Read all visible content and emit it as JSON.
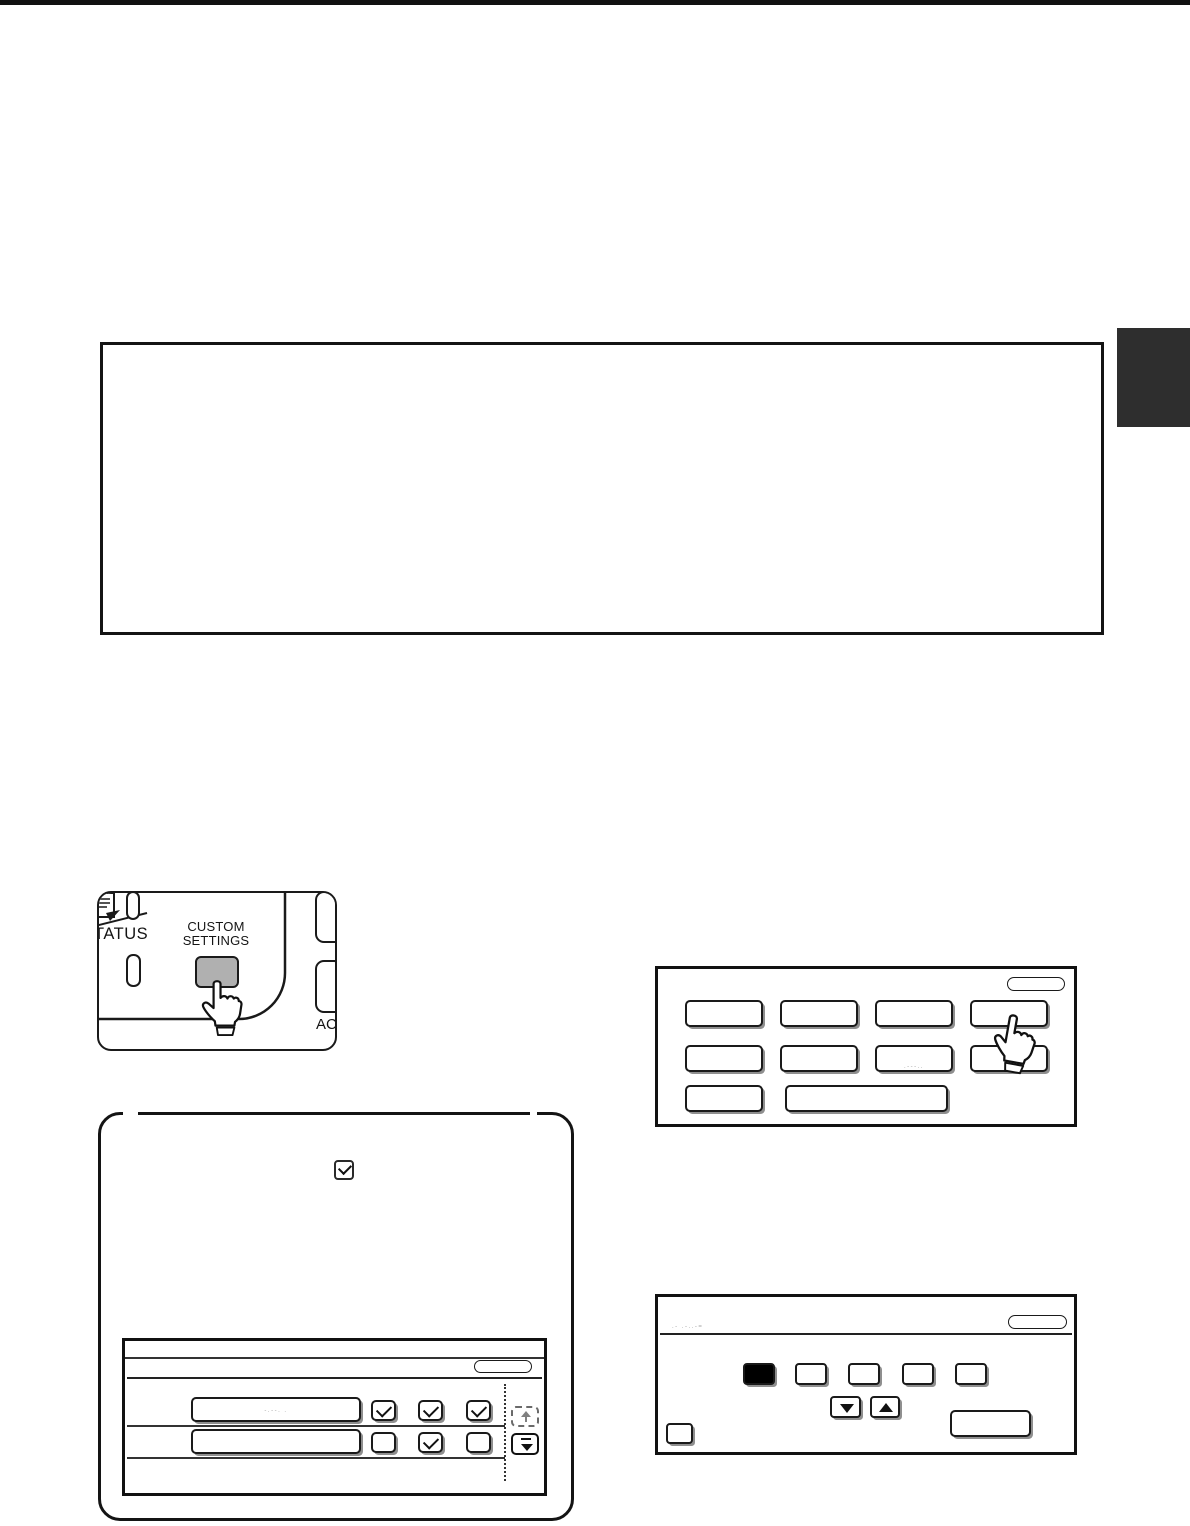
{
  "page": {
    "background": "#ffffff",
    "top_edge_color": "#111111",
    "side_tab_color": "#2e2e2e"
  },
  "note_frame": {
    "border_color": "#141414"
  },
  "panel": {
    "status_label_partial": "TATUS",
    "key_label_line1": "CUSTOM",
    "key_label_line2": "SETTINGS",
    "ac_label_partial": "AC",
    "key_color": "#b0b0b0"
  },
  "note_box": {
    "checkbox_state": "checked",
    "screen": {
      "row1": {
        "illegible_text": "-.--. .",
        "checkboxes": [
          "checked",
          "checked",
          "checked"
        ]
      },
      "row2": {
        "illegible_text": "",
        "checkboxes": [
          "unchecked",
          "checked",
          "unchecked"
        ]
      }
    }
  },
  "touch_screen_1": {
    "buttons_row1": 4,
    "buttons_row2": 4,
    "buttons_row3": 2,
    "row2_button3_illegible_text": ".---..",
    "pressed": "row1-button4"
  },
  "touch_screen_2": {
    "header_illegible_text": ".-  .-..-=",
    "selected_tab_color": "#000000",
    "tab_count": 5
  },
  "colors": {
    "line_art": "#1a1a1a",
    "key_gray": "#b0b0b0",
    "smudge_gray": "#a3a3a3"
  }
}
